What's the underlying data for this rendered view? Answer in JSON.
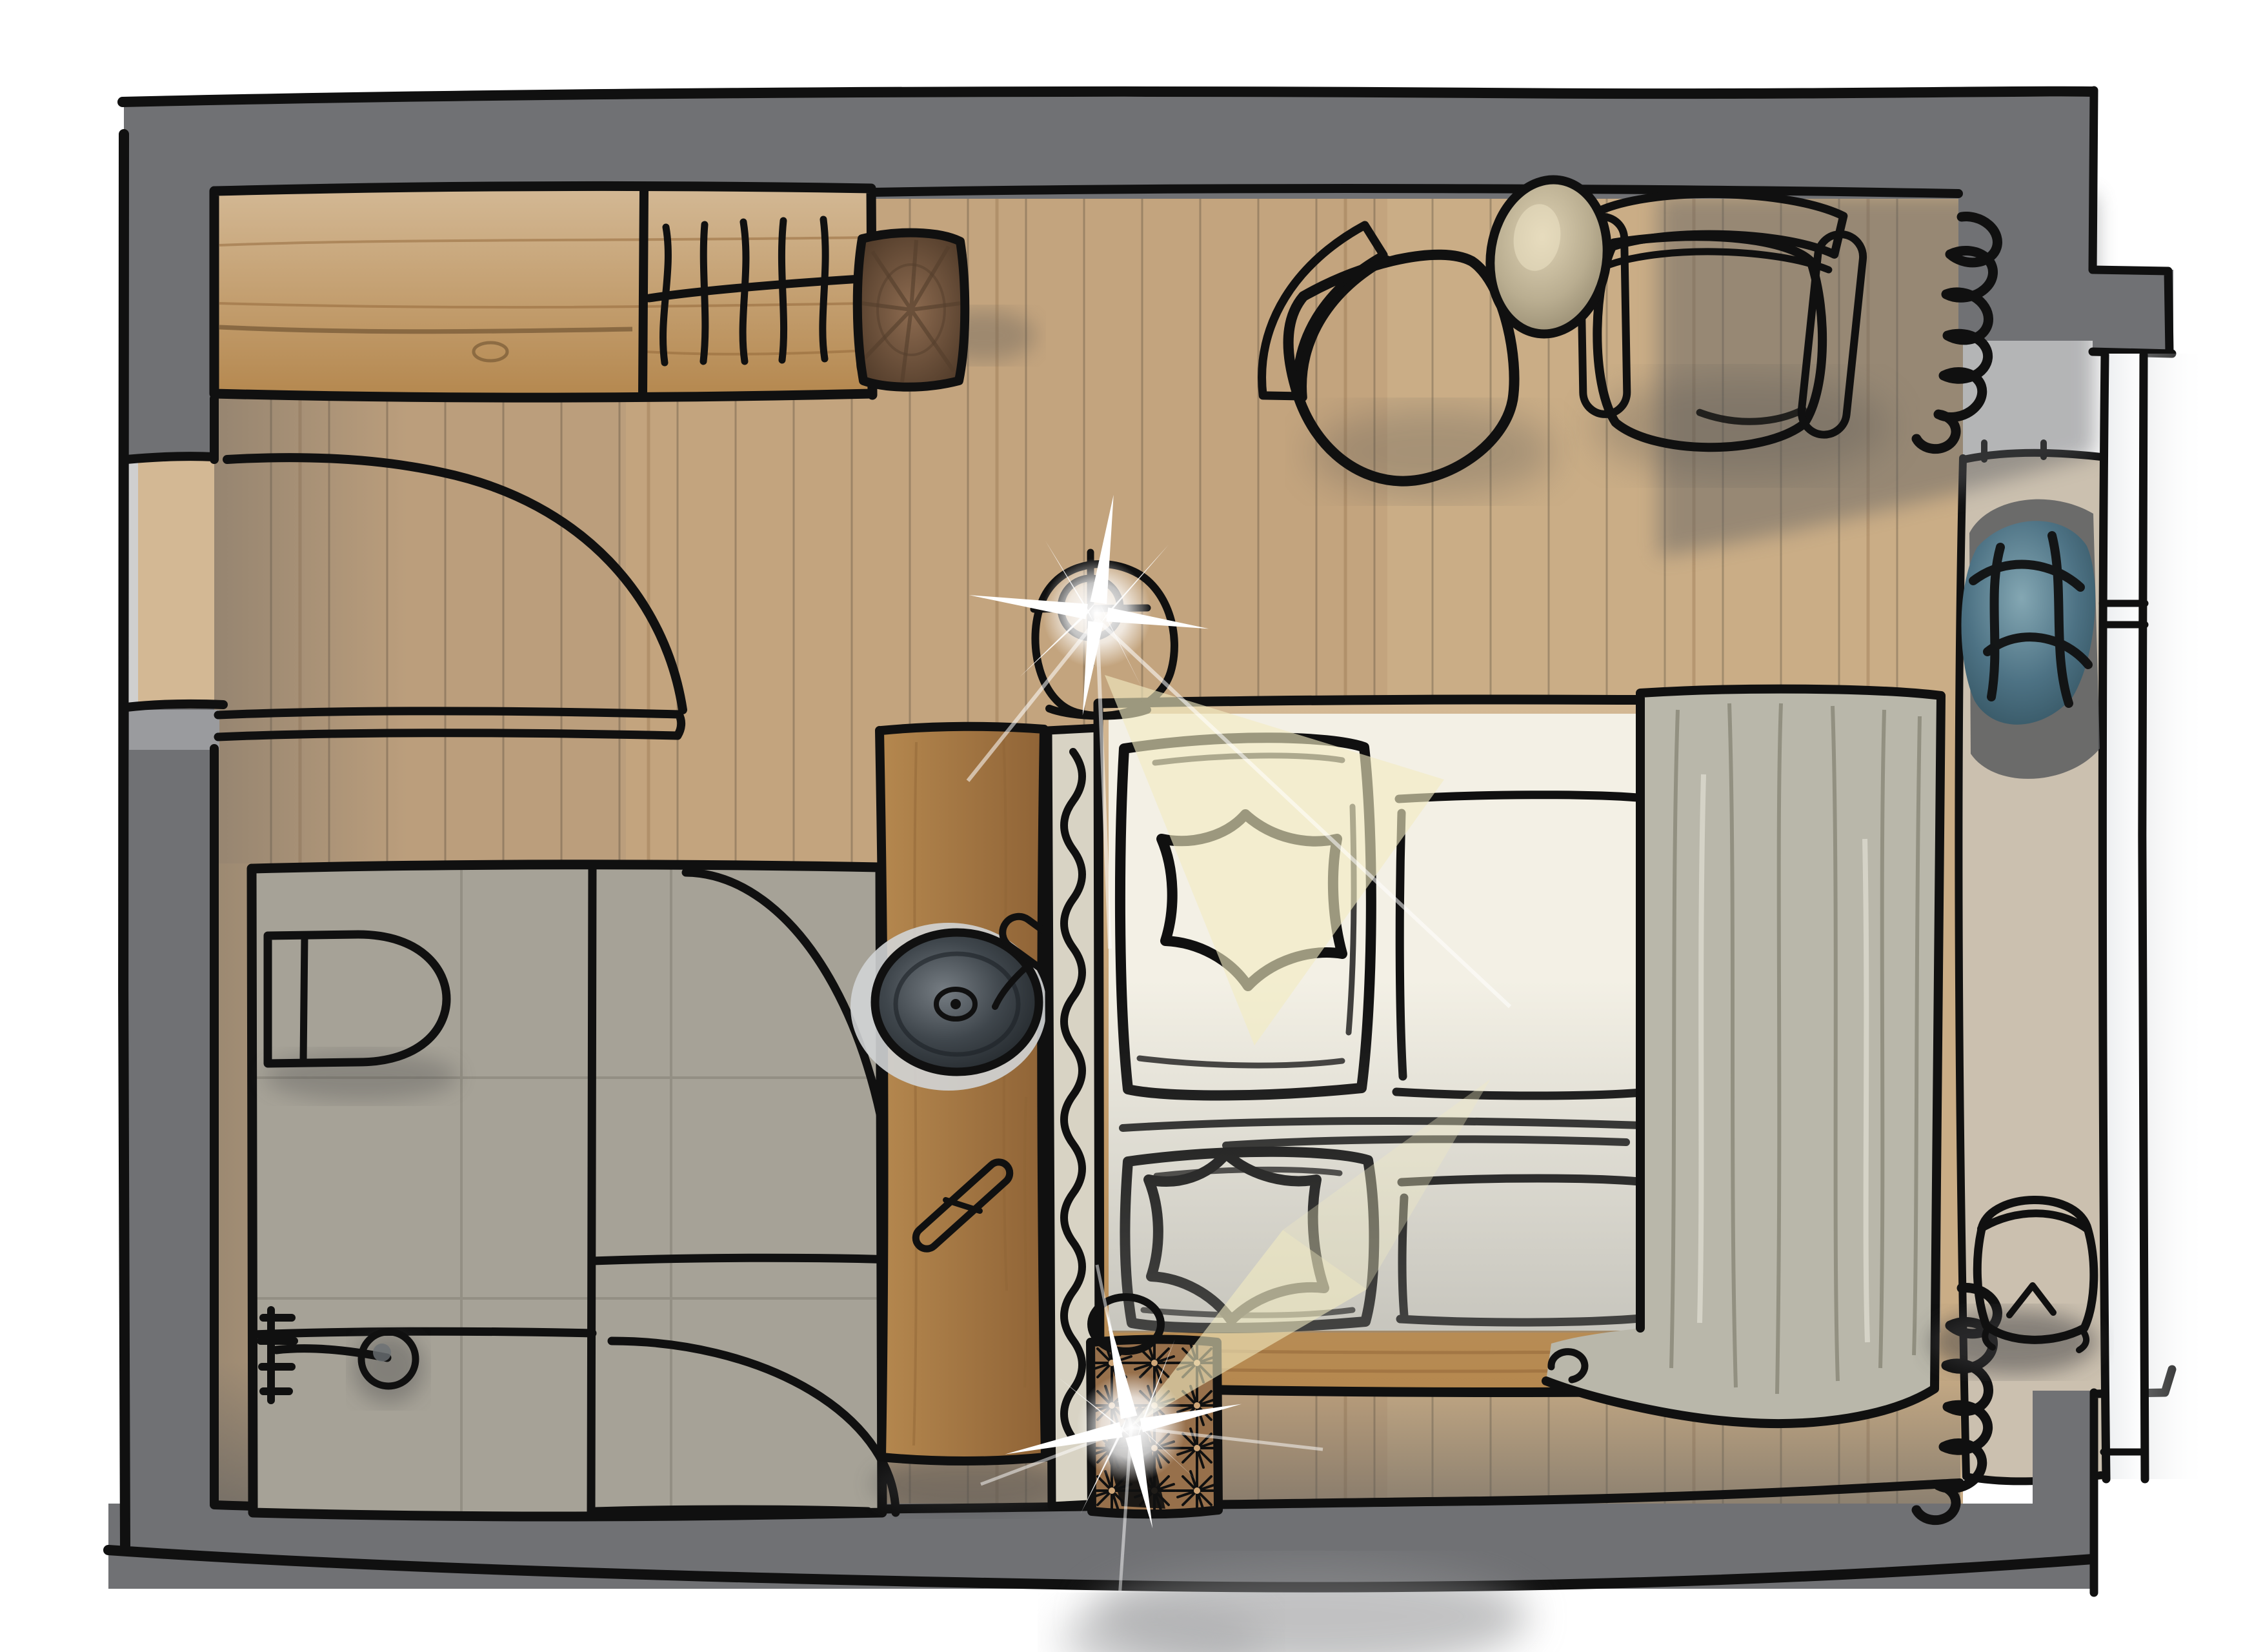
{
  "colors": {
    "ink": "#101010",
    "wall": "#707174",
    "wall_light": "#9a9b9e",
    "wall_dark": "#636467",
    "floor": "#c3a47e",
    "floor_light": "#d3b894",
    "plank": "#7c5833",
    "tile": "#a6a297",
    "tile_line": "#6f6c60",
    "porcelain": "#f4f1e6",
    "wood": "#b5884f",
    "wood_dark": "#8f6336",
    "log": "#8d6b50",
    "log_ring": "#533d2b",
    "linen": "#d8d3c4",
    "linen_line": "#73715f",
    "bedding": "#f3f0e5",
    "blanket": "#b9b7aa",
    "blue": "#4d7284",
    "blue_light": "#84a7b3",
    "blue_dark": "#31505d",
    "carpet": "#cbc0af",
    "ottoman": "#97704b",
    "ottoman_dark": "#3c2b1b",
    "ottoman_light": "#cfa678",
    "table": "#b9ad90",
    "metal": "#7a7f83",
    "metal_light": "#b9bdc0",
    "sink": "#3f464c",
    "sink_hi": "#767d83",
    "shadow": "#5a5c5e",
    "beam": "#f2ebc2",
    "glass": "#eceef0",
    "shower_metal": "#2c2f31",
    "lamp_body": "#3b3e41"
  }
}
